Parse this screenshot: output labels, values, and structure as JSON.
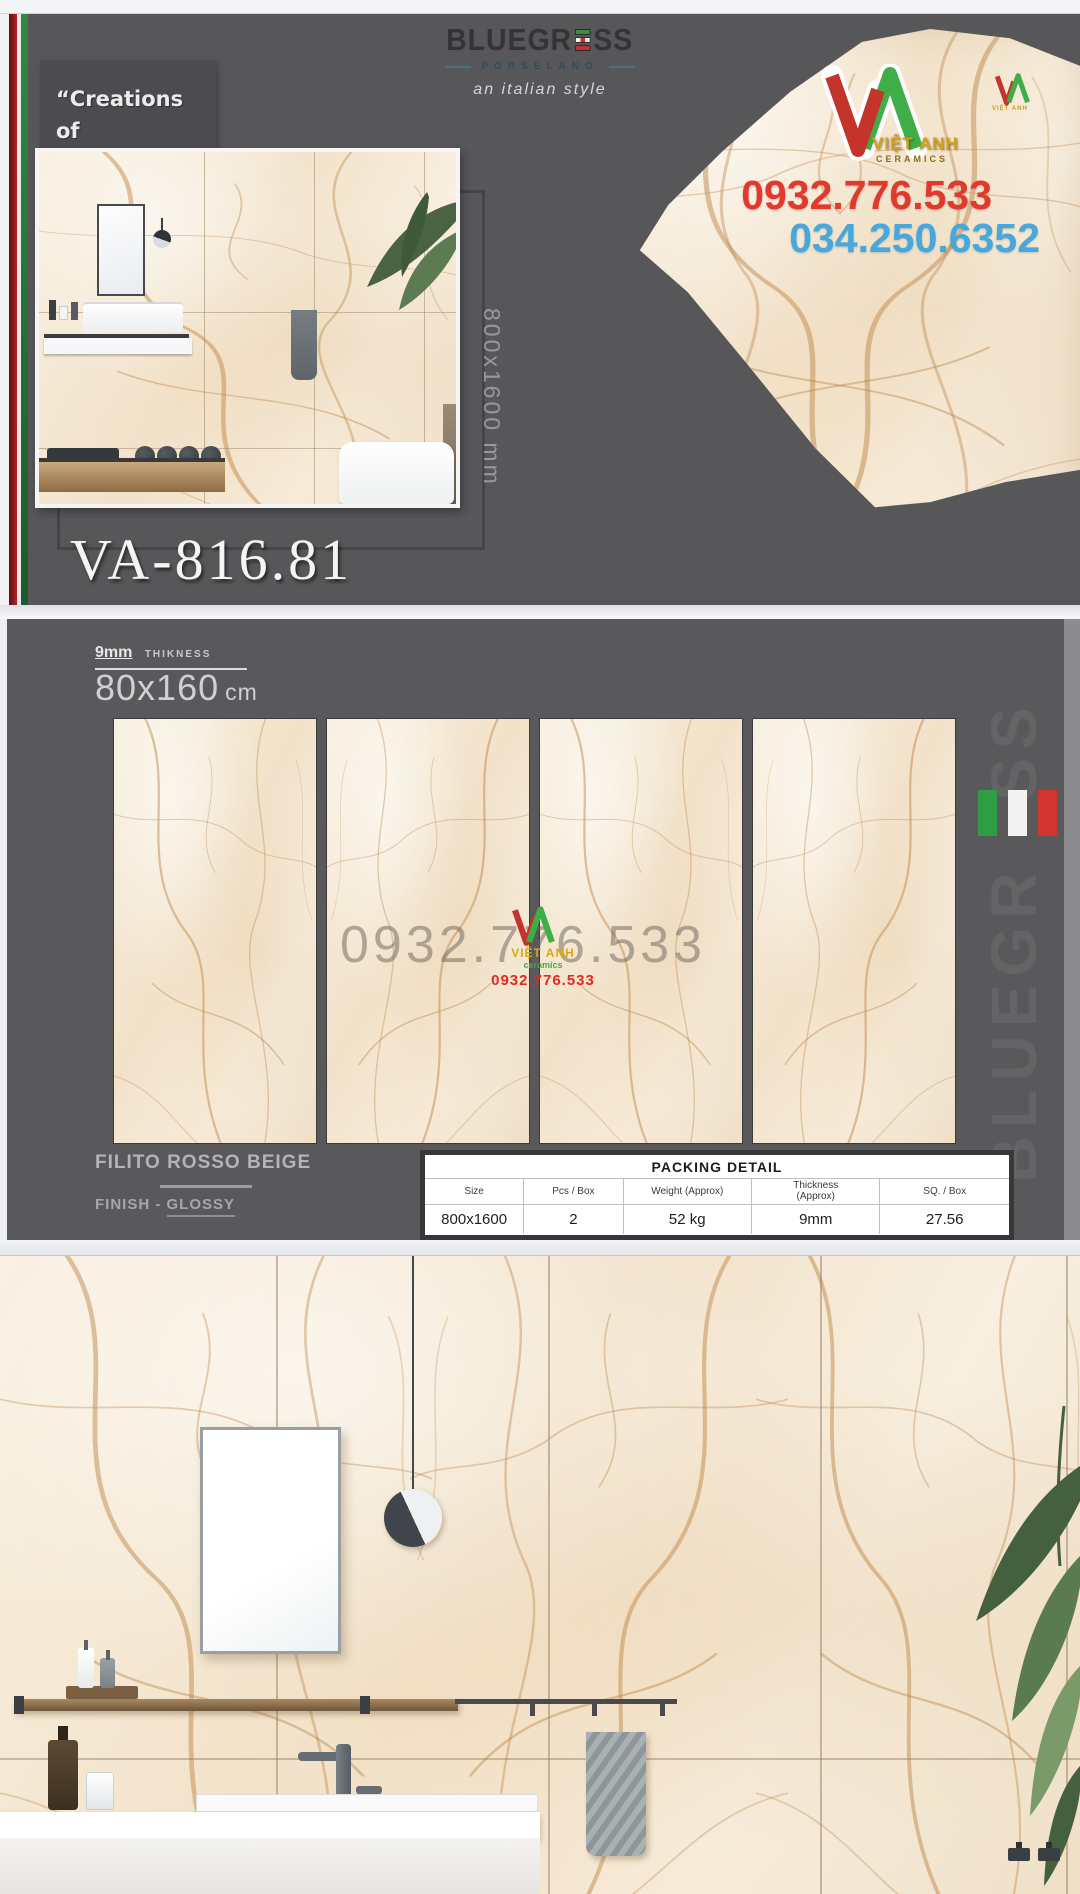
{
  "brand": {
    "name_left": "BLUEGR",
    "name_right": "SS",
    "subtitle": "PORSELANO",
    "style_tagline": "an italian style"
  },
  "quote": {
    "lines": [
      "“Creations of",
      "Ravishing",
      "Appeal”"
    ]
  },
  "contact": {
    "phone_primary": "0932.776.533",
    "phone_secondary": "034.250.6352"
  },
  "vietanh": {
    "name": "VIỆT ANH",
    "subtitle": "ceramics"
  },
  "product": {
    "code": "VA-816.81",
    "panel_dimension": "800x1600 mm",
    "thickness_value": "9mm",
    "thickness_label": "THIKNESS",
    "size_value": "80x160",
    "size_unit": "cm",
    "name": "FILITO ROSSO BEIGE",
    "finish_prefix": "FINISH - ",
    "finish_value": "GLOSSY"
  },
  "watermark": {
    "phone_gray": "0932.776.533",
    "phone_red": "0932.776.533",
    "name": "VIỆT ANH",
    "subtitle": "ceramics"
  },
  "vertical_brand": {
    "left": "BLUEGR",
    "right": "SS"
  },
  "packing": {
    "title": "PACKING DETAIL",
    "headers": [
      "Size",
      "Pcs / Box",
      "Weight (Approx)",
      "Thickness (Approx)",
      "SQ. / Box"
    ],
    "values": [
      "800x1600",
      "2",
      "52 kg",
      "9mm",
      "27.56"
    ]
  },
  "colors": {
    "section_bg": "#59595b",
    "accent_red": "#e3392d",
    "accent_blue": "#47a8dd",
    "stripe_red": "#a02025",
    "stripe_green": "#2a7d3c",
    "marble_base": "#f5e8d5",
    "gold": "#d4a017"
  }
}
